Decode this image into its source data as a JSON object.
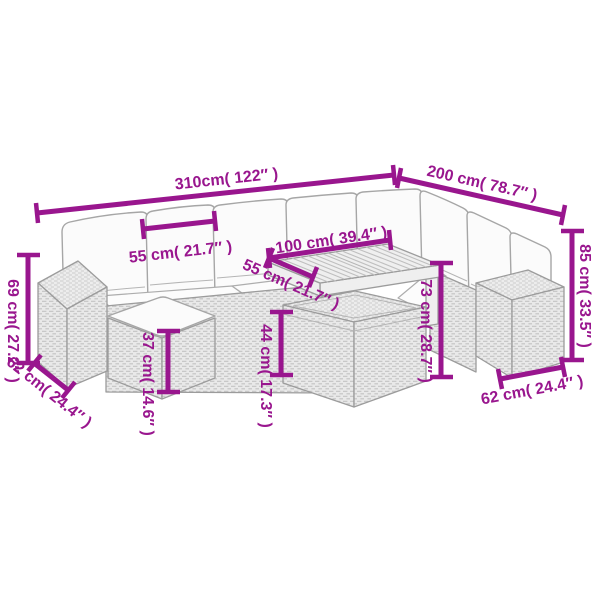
{
  "page": {
    "background": "#ffffff",
    "type": "product-dimension-diagram",
    "subject": "rattan garden corner sofa set with footstool, storage box and slatted table"
  },
  "style": {
    "dimension_color": "#99168E",
    "line_art_stroke": "#A6A6A6"
  },
  "dimensions": {
    "total_width": {
      "label": "310cm( 122″ )",
      "cm": "310",
      "inch": "122"
    },
    "total_depth": {
      "label": "200 cm( 78.7″ )",
      "cm": "200",
      "inch": "78.7"
    },
    "seat_cushion_width": {
      "label": "55 cm( 21.7″ )",
      "cm": "55",
      "inch": "21.7"
    },
    "table_length": {
      "label": "100 cm( 39.4″ )",
      "cm": "100",
      "inch": "39.4"
    },
    "table_depth": {
      "label": "55 cm( 21.7″ )",
      "cm": "55",
      "inch": "21.7"
    },
    "armrest_height": {
      "label": "69 cm( 27.2″ )",
      "cm": "69",
      "inch": "27.2"
    },
    "left_section_depth": {
      "label": "62 cm( 24.4″ )",
      "cm": "62",
      "inch": "24.4"
    },
    "footstool_height": {
      "label": "37 cm( 14.6″ )",
      "cm": "37",
      "inch": "14.6"
    },
    "storage_box_height": {
      "label": "44 cm( 17.3″ )",
      "cm": "44",
      "inch": "17.3"
    },
    "table_height": {
      "label": "73 cm( 28.7″ )",
      "cm": "73",
      "inch": "28.7"
    },
    "back_height": {
      "label": "85 cm( 33.5″ )",
      "cm": "85",
      "inch": "33.5"
    },
    "right_section_depth": {
      "label": "62 cm( 24.4″ )",
      "cm": "62",
      "inch": "24.4"
    }
  }
}
